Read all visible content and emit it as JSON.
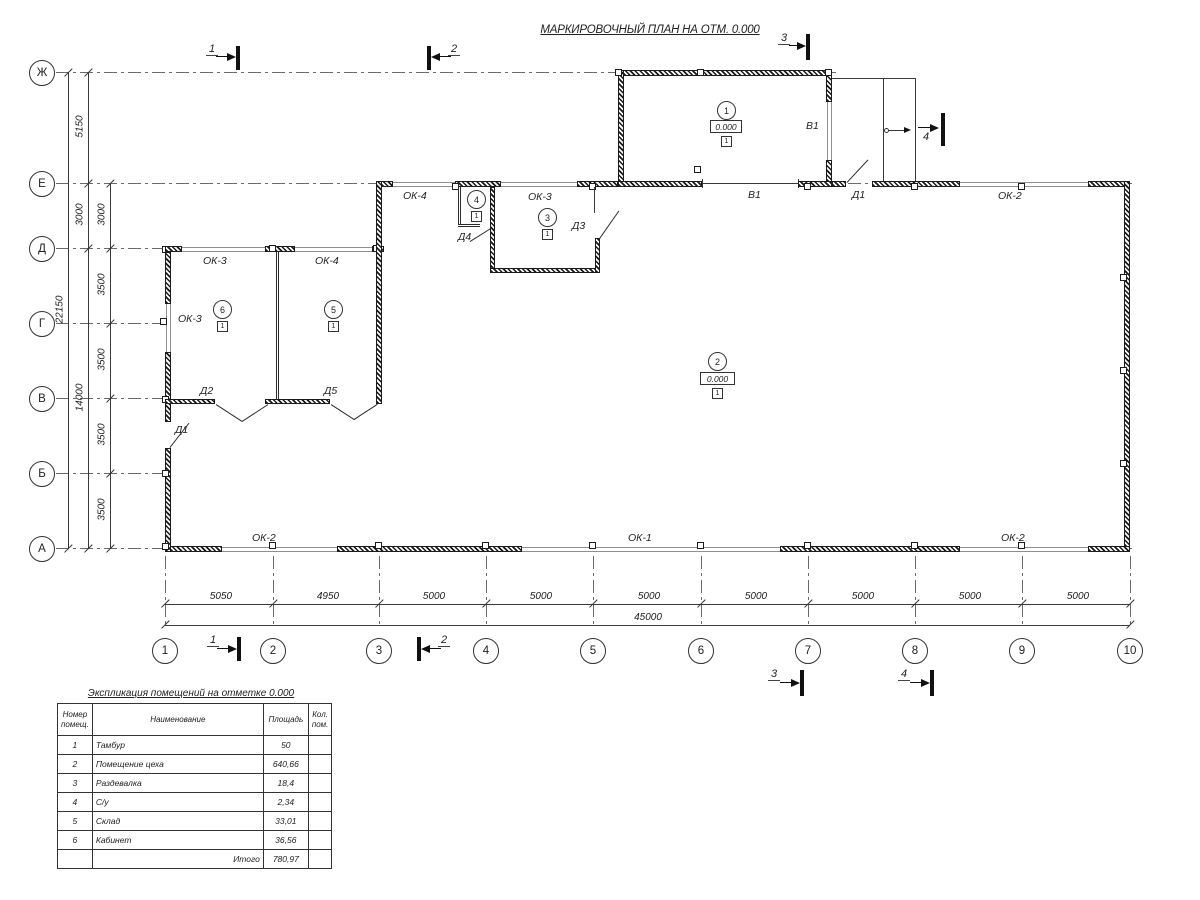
{
  "title": "МАРКИРОВОЧНЫЙ ПЛАН НА ОТМ. 0.000",
  "axes": {
    "rows": [
      "Ж",
      "Е",
      "Д",
      "Г",
      "В",
      "Б",
      "А"
    ],
    "cols": [
      "1",
      "2",
      "3",
      "4",
      "5",
      "6",
      "7",
      "8",
      "9",
      "10"
    ]
  },
  "dimensions": {
    "left_total": "22150",
    "left_outer": [
      "5150",
      "3000",
      "14000"
    ],
    "left_inner": [
      "3000",
      "3500",
      "3500",
      "3500",
      "3500"
    ],
    "bottom_segments": [
      "5050",
      "4950",
      "5000",
      "5000",
      "5000",
      "5000",
      "5000",
      "5000",
      "5000"
    ],
    "bottom_total": "45000"
  },
  "section_marks": {
    "m1": "1",
    "m2": "2",
    "m3": "3",
    "m4": "4"
  },
  "marks": {
    "ok1": "ОК-1",
    "ok2": "ОК-2",
    "ok3": "ОК-3",
    "ok4": "ОК-4",
    "d1": "Д1",
    "d2": "Д2",
    "d3": "Д3",
    "d4": "Д4",
    "d5": "Д5",
    "v1": "В1"
  },
  "rooms": {
    "r1": {
      "num": "1",
      "elev": "0.000",
      "floor": "1"
    },
    "r2": {
      "num": "2",
      "elev": "0.000",
      "floor": "1"
    },
    "r3": {
      "num": "3",
      "floor": "1"
    },
    "r4": {
      "num": "4",
      "floor": "1"
    },
    "r5": {
      "num": "5",
      "floor": "1"
    },
    "r6": {
      "num": "6",
      "floor": "1"
    }
  },
  "table": {
    "title": "Экспликация помещений на отметке 0.000",
    "headers": [
      "Номер помещ.",
      "Наименование",
      "Площадь",
      "Кол. пом."
    ],
    "rows": [
      [
        "1",
        "Тамбур",
        "50",
        ""
      ],
      [
        "2",
        "Помещение цеха",
        "640,66",
        ""
      ],
      [
        "3",
        "Раздевалка",
        "18,4",
        ""
      ],
      [
        "4",
        "С/у",
        "2,34",
        ""
      ],
      [
        "5",
        "Склад",
        "33,01",
        ""
      ],
      [
        "6",
        "Кабинет",
        "36,56",
        ""
      ]
    ],
    "total_label": "Итого",
    "total_value": "780,97"
  }
}
